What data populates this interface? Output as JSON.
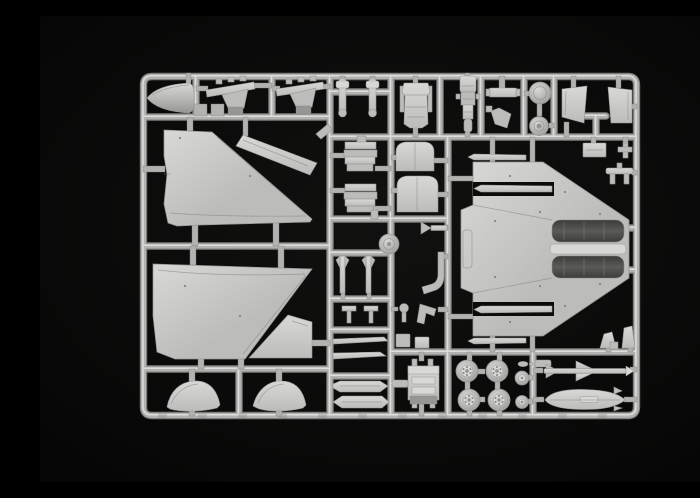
{
  "scene": {
    "type": "photograph",
    "caption": "Photograph of a light grey injection-moulded polystyrene sprue (parts tree) from a plastic model aircraft kit, laid on a black background. The rectangular runner frame holds two large delta-wing panels, a nose radome, a fuselage half with twin engine bays, intake ramps, ejection-seat and cockpit parts, four main wheels, two nose wheels, a slender air-to-air missile and a drop-tank half, plus many small struts, pylons and fittings.",
    "background_color": "#050505"
  },
  "colors": {
    "background": "#050505",
    "vignette": "#111110",
    "runner_base": "#b2b2b0",
    "runner_highlight": "#dddddb",
    "runner_shadow": "#7e7e7c",
    "plastic_light": "#d8d8d6",
    "plastic_mid": "#bcbcba",
    "plastic_dark": "#969694",
    "detail_line": "#848482",
    "recess_dark": "#3c3c3a",
    "recess_mid": "#5a5a58"
  },
  "sprue": {
    "material": "light grey polystyrene",
    "layout": "rectangular runner frame with internal ribs dividing part cells",
    "parts": [
      {
        "id": "nose-cone",
        "label": "Nose cone (radome)"
      },
      {
        "id": "splitter-plate-a",
        "label": "Intake splitter plate (left)"
      },
      {
        "id": "splitter-plate-b",
        "label": "Intake splitter plate (right)"
      },
      {
        "id": "gear-struts",
        "label": "Landing gear struts"
      },
      {
        "id": "upper-wing-panel",
        "label": "Delta wing panel (upper)"
      },
      {
        "id": "upper-wing-slat",
        "label": "Wing leading-edge slat"
      },
      {
        "id": "lower-wing-panel",
        "label": "Delta wing panel (lower)"
      },
      {
        "id": "fin-half",
        "label": "Vertical fin half"
      },
      {
        "id": "canopy-fairings",
        "label": "Canopy fairing halves"
      },
      {
        "id": "seat-back",
        "label": "Ejection seat back"
      },
      {
        "id": "cockpit-tub",
        "label": "Cockpit tub"
      },
      {
        "id": "gear-brace",
        "label": "Landing gear bay brace"
      },
      {
        "id": "fan-discs",
        "label": "Engine fan and wheel hub discs"
      },
      {
        "id": "intake-ramps",
        "label": "Air intake ramp panels"
      },
      {
        "id": "intake-covers",
        "label": "Intake trunk covers"
      },
      {
        "id": "louvre-ramps",
        "label": "Boundary-layer ramp stacks"
      },
      {
        "id": "fuselage-half",
        "label": "Fuselage half with delta wings and twin engine bays"
      },
      {
        "id": "edge-slats",
        "label": "Leading-edge slat strips"
      },
      {
        "id": "ejection-seat",
        "label": "Ejection seat"
      },
      {
        "id": "main-wheels",
        "label": "Main wheels"
      },
      {
        "id": "nose-wheels",
        "label": "Nose wheels"
      },
      {
        "id": "missile",
        "label": "Air-to-air missile"
      },
      {
        "id": "drop-tank",
        "label": "Drop tank half"
      },
      {
        "id": "pylons",
        "label": "Underwing pylons"
      },
      {
        "id": "small-fittings",
        "label": "Actuators, antennas and small fittings"
      }
    ]
  }
}
